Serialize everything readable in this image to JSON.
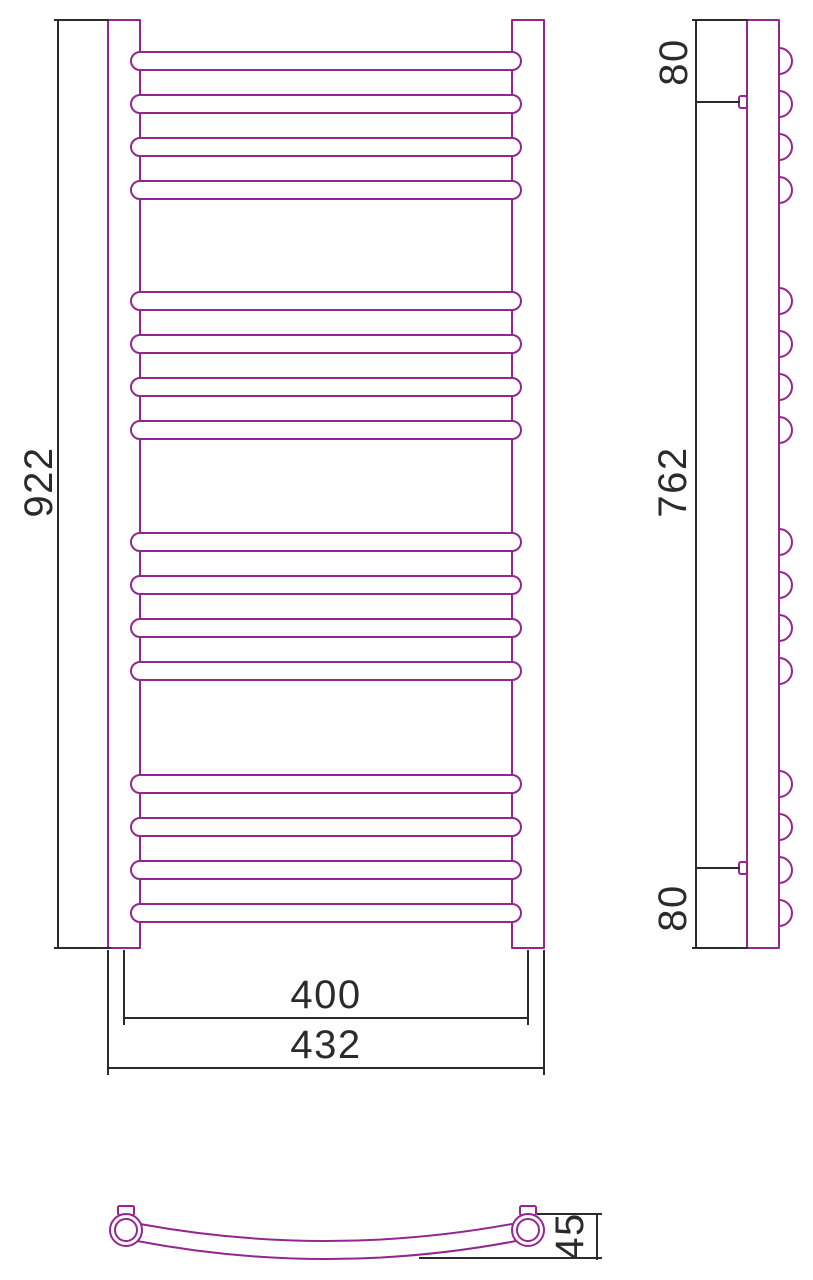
{
  "drawing": {
    "background": "#FFFFFF",
    "outline_color": "#93278F",
    "dimension_color": "#2B2B2B",
    "views": {
      "front": {
        "height_label": "922",
        "rail_span_label": "400",
        "overall_width_label": "432"
      },
      "side": {
        "top_bracket_offset_label": "80",
        "bracket_spacing_label": "762",
        "bottom_bracket_offset_label": "80"
      },
      "bottom": {
        "bow_depth_label": "45"
      }
    }
  }
}
